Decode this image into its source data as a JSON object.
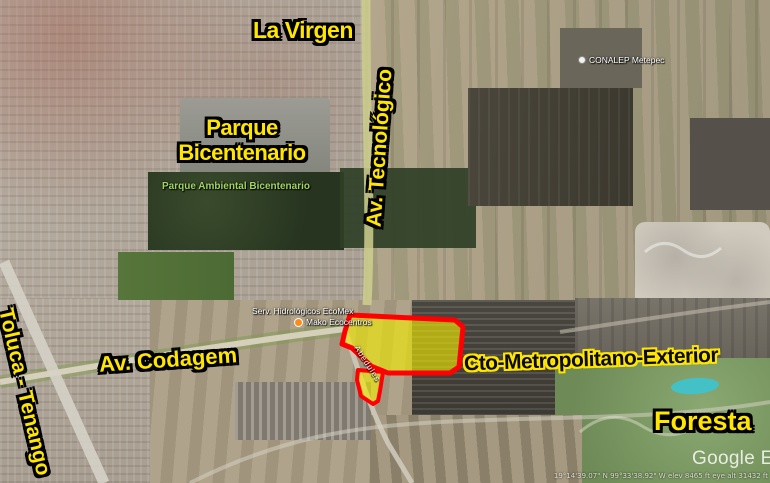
{
  "map": {
    "labels": {
      "la_virgen": "La Virgen",
      "parque_line1": "Parque",
      "parque_line2": "Bicentenario",
      "av_tecnologico": "Av. Tecnológico",
      "toluca_tenango": "Toluca - Tenango",
      "av_codagem": "Av. Codagem",
      "cto_metropolitano": "Cto-Metropolitano-Exterior",
      "foresta": "Foresta"
    },
    "poi": {
      "parque_ambiental": "Parque Ambiental Bicentenario",
      "conalep": "CONALEP Metepec",
      "ecomex": "Serv. Hidrológicos EcoMex",
      "mako": "Mako Ecocentros",
      "street_abedules": "Abedules"
    },
    "watermark": "Google Earth",
    "status_bar": "19°14'39.07\" N   99°33'38.92\" W   elev 8465 ft   eye alt 31432 ft",
    "colors": {
      "label_yellow": "#FFE600",
      "label_outline": "#000000",
      "label_inverse_text": "#0B0B0B",
      "parcel_stroke": "#FF0000",
      "parcel_fill": "#EDE800",
      "poi_green": "#9FD65E",
      "poi_white": "#FFFFFF",
      "marker_orange": "#FF8C1A",
      "pond_turquoise": "#3FC3CC"
    }
  }
}
